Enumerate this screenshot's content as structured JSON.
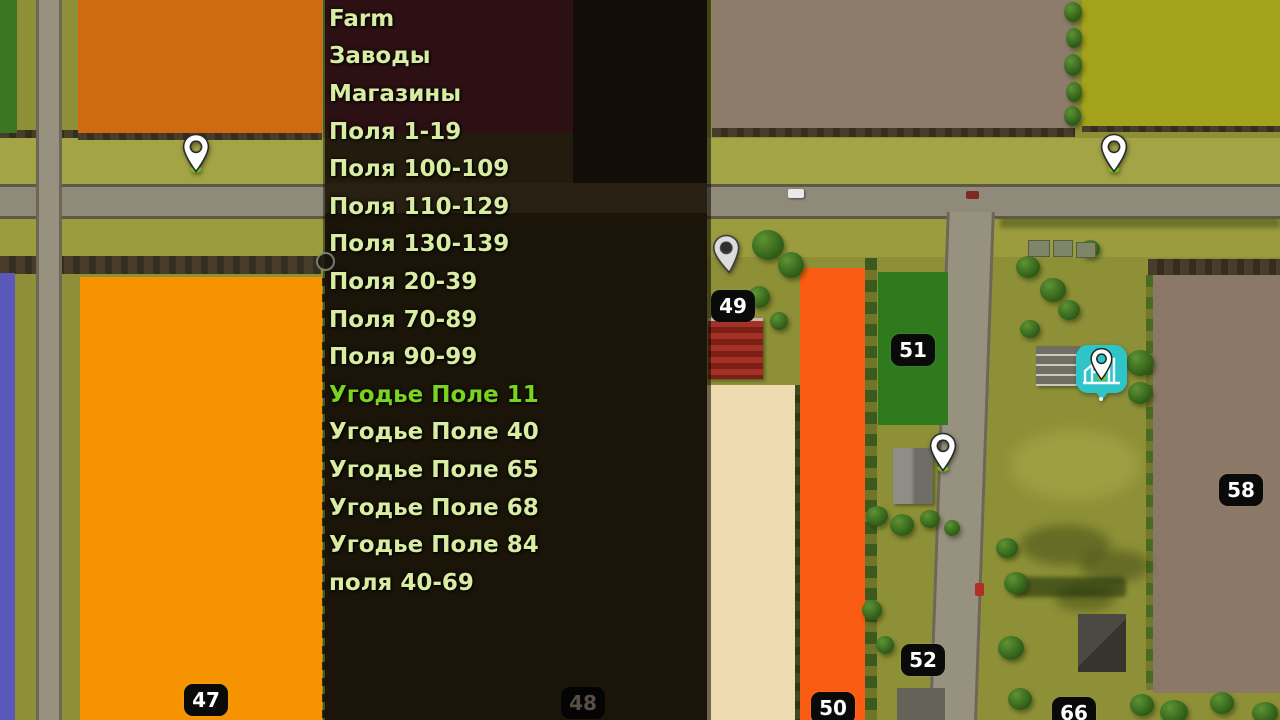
{
  "menu": {
    "items": [
      {
        "label": "Farm",
        "highlighted": false
      },
      {
        "label": "Заводы",
        "highlighted": false
      },
      {
        "label": "Магазины",
        "highlighted": false
      },
      {
        "label": "Поля 1-19",
        "highlighted": false
      },
      {
        "label": "Поля 100-109",
        "highlighted": false
      },
      {
        "label": "Поля 110-129",
        "highlighted": false
      },
      {
        "label": "Поля 130-139",
        "highlighted": false
      },
      {
        "label": "Поля 20-39",
        "highlighted": false
      },
      {
        "label": "Поля 70-89",
        "highlighted": false
      },
      {
        "label": "Поля 90-99",
        "highlighted": false
      },
      {
        "label": "Угодье Поле 11",
        "highlighted": true
      },
      {
        "label": "Угодье Поле 40",
        "highlighted": false
      },
      {
        "label": "Угодье Поле 65",
        "highlighted": false
      },
      {
        "label": "Угодье Поле 68",
        "highlighted": false
      },
      {
        "label": "Угодье Поле 84",
        "highlighted": false
      },
      {
        "label": "поля 40-69",
        "highlighted": false
      }
    ],
    "text_color": "#d9eda2",
    "highlight_color": "#7ad41f"
  },
  "map": {
    "field_badges": [
      {
        "number": "47",
        "x": 184,
        "y": 684,
        "dimmed": false
      },
      {
        "number": "48",
        "x": 561,
        "y": 687,
        "dimmed": true
      },
      {
        "number": "49",
        "x": 711,
        "y": 290,
        "dimmed": false
      },
      {
        "number": "50",
        "x": 811,
        "y": 692,
        "dimmed": false
      },
      {
        "number": "51",
        "x": 891,
        "y": 334,
        "dimmed": false
      },
      {
        "number": "52",
        "x": 901,
        "y": 644,
        "dimmed": false
      },
      {
        "number": "58",
        "x": 1219,
        "y": 474,
        "dimmed": false
      },
      {
        "number": "66",
        "x": 1052,
        "y": 697,
        "dimmed": false
      }
    ],
    "pins": [
      {
        "type": "white",
        "x": 181,
        "y": 133
      },
      {
        "type": "white",
        "x": 1099,
        "y": 133
      },
      {
        "type": "white",
        "x": 928,
        "y": 432
      },
      {
        "type": "gray",
        "x": 712,
        "y": 234
      }
    ],
    "factory_marker": {
      "x": 1076,
      "y": 345,
      "color": "#2fc5c8"
    },
    "colors": {
      "field_orange_dark": "#cd6a12",
      "field_orange_bright": "#f59300",
      "field_orange_red": "#f95c12",
      "field_green_dark": "#2e7a1d",
      "field_green_topleft": "#39761f",
      "field_purple": "#5a58b8",
      "field_brown": "#8d7c6c",
      "field_brown_58": "#8b7866",
      "field_olive": "#a4a21a",
      "field_cream": "#eedbb0",
      "grass": "#8d9036",
      "road": "#8f8a7a",
      "badge_bg": "#0a0a0a"
    }
  }
}
